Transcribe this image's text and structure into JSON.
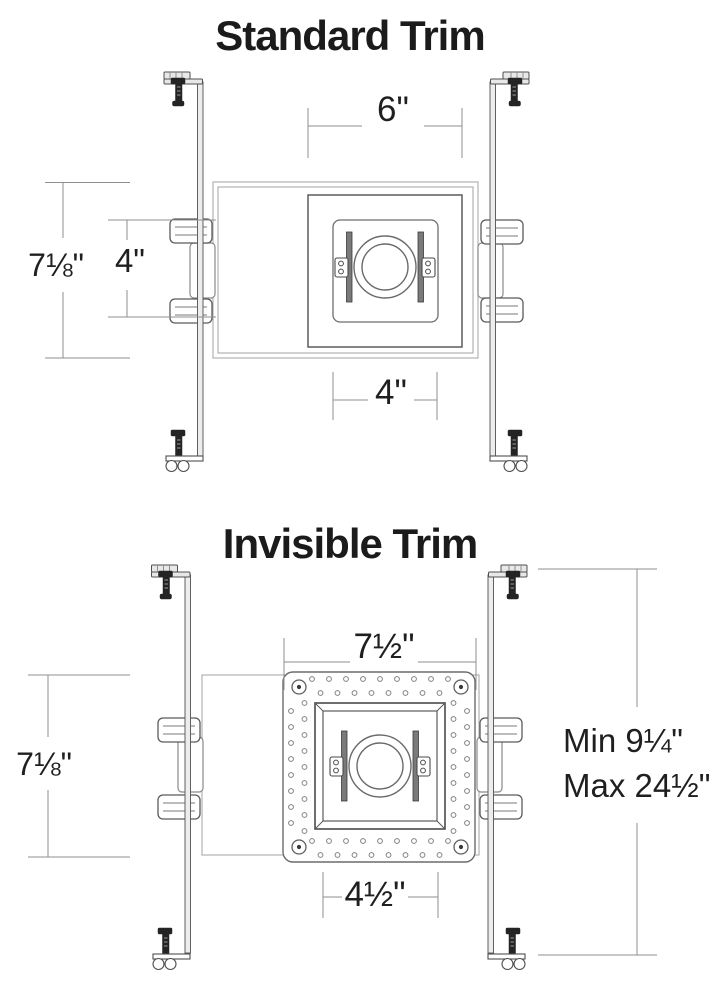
{
  "colors": {
    "background": "#ffffff",
    "linework": "#5c5c5c",
    "light_linework": "#b2b2b2",
    "dimension_lines": "#8f8f8f",
    "text": "#1d1d1d",
    "screw_fill": "#242424"
  },
  "standard": {
    "title": "Standard Trim",
    "dims": {
      "top_width": "6\"",
      "height": "7⅛\"",
      "inner_height": "4\"",
      "bottom_width": "4\""
    }
  },
  "invisible": {
    "title": "Invisible Trim",
    "dims": {
      "top_width": "7½\"",
      "height": "7⅛\"",
      "bottom_width": "4½\"",
      "hanger_min": "Min 9¼\"",
      "hanger_max": "Max 24½\""
    }
  }
}
